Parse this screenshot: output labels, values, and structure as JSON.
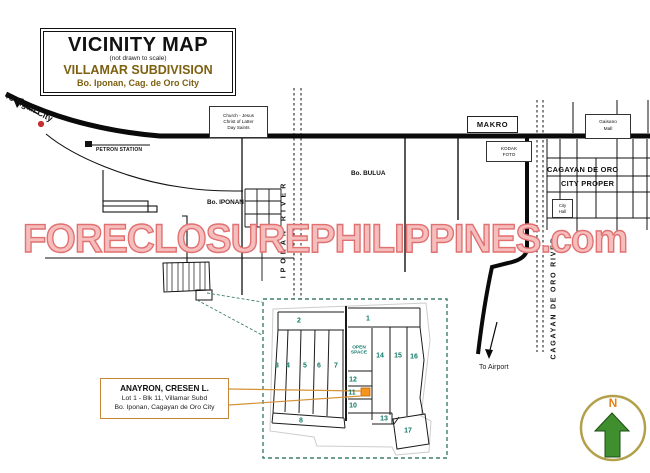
{
  "title_box": {
    "title": "VICINITY MAP",
    "subtitle": "(not drawn to scale)",
    "subdivision": "VILLAMAR SUBDIVISION",
    "location": "Bo. Iponan, Cag. de Oro City"
  },
  "watermark": {
    "text": "FORECLOSUREPHILIPPINES.com"
  },
  "roads": {
    "to_iligan_city": "To Iligan City",
    "to_airport": "To Airport"
  },
  "landmarks": {
    "petron_station": "PETRON STATION",
    "makro": "MAKRO",
    "church": [
      "Church - Jesus",
      "Christ of Latter",
      "Day Saints"
    ],
    "kodak": [
      "KODAK",
      "FOTO"
    ],
    "gaisano": [
      "Gaisano",
      "Mall"
    ],
    "city_hall": [
      "City",
      "Hall"
    ]
  },
  "areas": {
    "bo_iponan": "Bo. IPONAN",
    "bo_bulua": "Bo. BULUA",
    "city_proper": [
      "CAGAYAN DE ORO",
      "CITY PROPER"
    ]
  },
  "rivers": {
    "iponan": "IPONAN RIVER",
    "cagayan_de_oro": "CAGAYAN DE ORO RIVER"
  },
  "compass": {
    "north": "N"
  },
  "callout": {
    "line1": "ANAYRON, CRESEN L.",
    "line2": "Lot  1 - Blk 11, Villamar Subd",
    "line3": "Bo. Iponan, Cagayan de Oro City"
  },
  "inset": {
    "open_space": [
      "OPEN",
      "SPACE"
    ],
    "lots": [
      "1",
      "2",
      "3",
      "4",
      "5",
      "6",
      "7",
      "8",
      "10",
      "11",
      "12",
      "13",
      "14",
      "15",
      "16",
      "17"
    ]
  },
  "colors": {
    "title_brown": "#7d6010",
    "watermark_pink": "#f6bdbd",
    "watermark_outline": "#e17070",
    "inset_teal": "#0f7a67",
    "callout_orange": "#c9873a",
    "highlight_orange": "#f7941d",
    "compass_green": "#3f8f2f",
    "compass_n_orange": "#e2821c",
    "marker_red": "#c53030"
  }
}
